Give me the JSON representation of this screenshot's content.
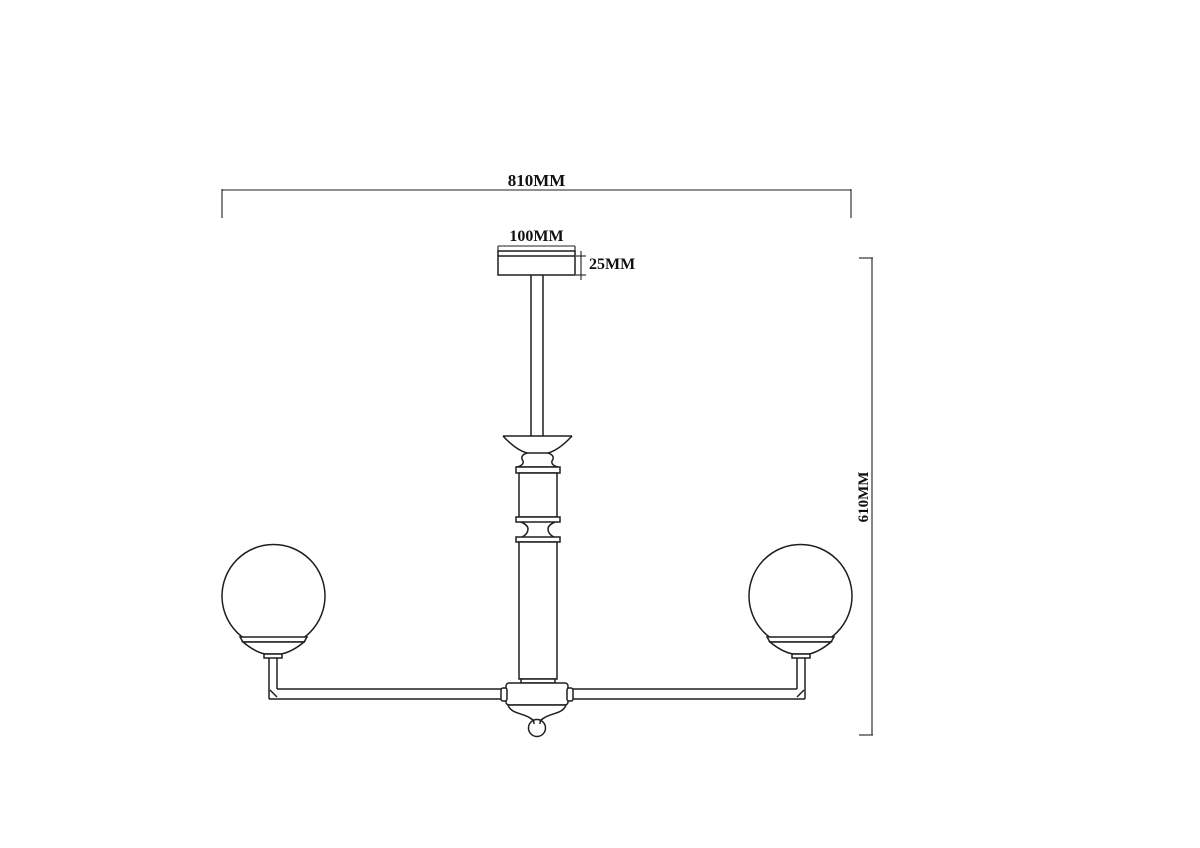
{
  "page": {
    "background": "#ffffff",
    "line_color": "#1f1f1f",
    "text_color": "#111111"
  },
  "drawing": {
    "kind": "technical dimension drawing, front elevation, two-arm globe chandelier",
    "labels": {
      "overall_width": "810MM",
      "canopy_width": "100MM",
      "canopy_height": "25MM",
      "overall_height": "610MM"
    }
  }
}
